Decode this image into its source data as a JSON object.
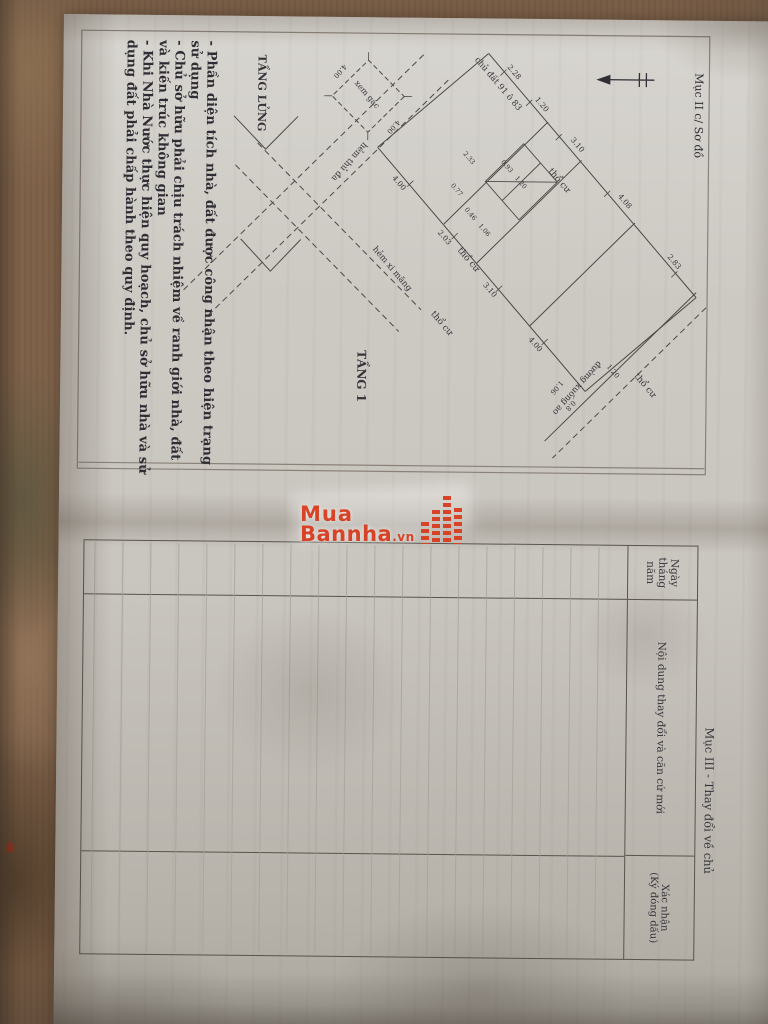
{
  "colors": {
    "watermark_red": "#d84327",
    "ink": "#4b4a45",
    "paper": "#c9c5bf"
  },
  "watermark": {
    "line1": "Mua",
    "line2": "Bannha",
    "suffix": ".vn",
    "icon": "building-bars-icon"
  },
  "diagram_page": {
    "section_title": "Mục II c/ Sơ đồ",
    "floor_labels": {
      "mezzanine": "TẦNG LỬNG",
      "first_floor": "TẦNG 1",
      "mezzanine_note": "xem gác"
    },
    "notes": [
      "- Phần diện tích nhà, đất được công nhận theo hiện trạng sử dụng",
      "- Chủ sở hữu phải chịu trách nhiệm về ranh giới nhà, đất và kiến trúc không gian",
      "- Khi Nhà Nước thực hiện quy hoạch, chủ sở hữu nhà và sử dụng đất phải chấp hành theo quy định."
    ],
    "plan_texts": [
      {
        "t": "chủ đất 91 ô 83",
        "x": 52,
        "y": 214,
        "r": -41,
        "s": 8.5
      },
      {
        "t": "thổ cư",
        "x": 148,
        "y": 152,
        "r": -41,
        "s": 9
      },
      {
        "t": "thổ cư",
        "x": 228,
        "y": 242,
        "r": -41,
        "s": 9
      },
      {
        "t": "thổ cư",
        "x": 292,
        "y": 268,
        "r": -41,
        "s": 9
      },
      {
        "t": "thổ cư",
        "x": 352,
        "y": 64,
        "r": -41,
        "s": 9
      },
      {
        "t": "hẻm thủ đa",
        "x": 128,
        "y": 362,
        "r": 41,
        "s": 8.5
      },
      {
        "t": "hẻm xi măng",
        "x": 238,
        "y": 318,
        "r": -41,
        "s": 8.5
      },
      {
        "t": "đường xuống ao",
        "x": 352,
        "y": 132,
        "r": 41,
        "s": 8.5
      },
      {
        "t": "TẦNG 1",
        "x": 344,
        "y": 350,
        "r": 0,
        "s": 12,
        "b": 1
      },
      {
        "t": "TẦNG LỬNG",
        "x": 62,
        "y": 452,
        "r": 0,
        "s": 11,
        "b": 1
      },
      {
        "t": "xem gác",
        "x": 64,
        "y": 345,
        "r": -41,
        "s": 8
      },
      {
        "t": "2.28",
        "x": 40,
        "y": 198,
        "r": -41,
        "s": 7.5
      },
      {
        "t": "1.20",
        "x": 72,
        "y": 170,
        "r": -41,
        "s": 7.5
      },
      {
        "t": "3.10",
        "x": 112,
        "y": 134,
        "r": -41,
        "s": 7.5
      },
      {
        "t": "4.08",
        "x": 168,
        "y": 86,
        "r": -41,
        "s": 7.5
      },
      {
        "t": "2.83",
        "x": 228,
        "y": 36,
        "r": -41,
        "s": 7.5
      },
      {
        "t": "4.00",
        "x": 152,
        "y": 312,
        "r": -41,
        "s": 7.5
      },
      {
        "t": "2.03",
        "x": 206,
        "y": 266,
        "r": -41,
        "s": 7.5
      },
      {
        "t": "3.10",
        "x": 258,
        "y": 220,
        "r": -41,
        "s": 7.5
      },
      {
        "t": "4.00",
        "x": 312,
        "y": 174,
        "r": -41,
        "s": 7.5
      },
      {
        "t": "0.93",
        "x": 134,
        "y": 204,
        "r": -41,
        "s": 6.5
      },
      {
        "t": "1.20",
        "x": 150,
        "y": 190,
        "r": -41,
        "s": 6.5
      },
      {
        "t": "2.33",
        "x": 126,
        "y": 242,
        "r": -41,
        "s": 6.5
      },
      {
        "t": "0.77",
        "x": 158,
        "y": 254,
        "r": -41,
        "s": 6.5
      },
      {
        "t": "0.46",
        "x": 182,
        "y": 240,
        "r": -41,
        "s": 6.5
      },
      {
        "t": "1.06",
        "x": 198,
        "y": 226,
        "r": -41,
        "s": 6.5
      },
      {
        "t": "1.06",
        "x": 352,
        "y": 152,
        "r": 41,
        "s": 7
      },
      {
        "t": "0.8",
        "x": 370,
        "y": 138,
        "r": 41,
        "s": 7
      },
      {
        "t": "1.20",
        "x": 338,
        "y": 96,
        "r": -41,
        "s": 7
      },
      {
        "t": "4.00",
        "x": 93,
        "y": 318,
        "r": 41,
        "s": 7
      },
      {
        "t": "4.00",
        "x": 38,
        "y": 372,
        "r": 41,
        "s": 7
      }
    ]
  },
  "table_page": {
    "section_title": "Mục III - Thay đổi về chủ",
    "columns": {
      "date": "Ngày tháng năm",
      "content": "Nội dung thay đổi và căn cứ mới",
      "confirm_line1": "Xác nhận",
      "confirm_line2": "(Ký đóng dấu)"
    },
    "ruled_row_count": 19,
    "rows": []
  }
}
